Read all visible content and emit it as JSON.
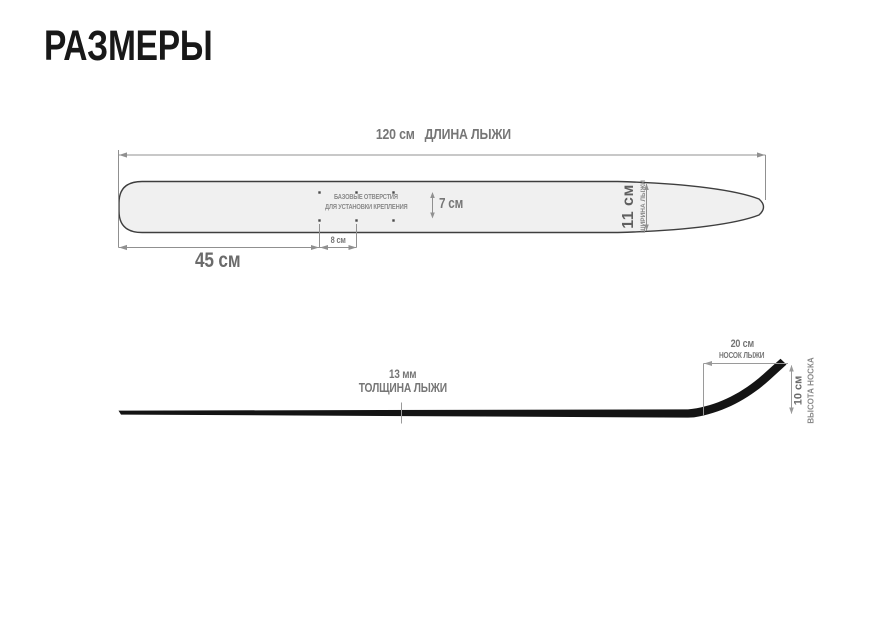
{
  "page": {
    "title": "РАЗМЕРЫ"
  },
  "colors": {
    "title_text": "#181818",
    "dimension_text": "#767676",
    "dimension_line": "#909090",
    "ski_fill": "#f0f0f0",
    "ski_outline": "#3e3e3e",
    "side_profile": "#141414"
  },
  "top_view": {
    "length_value": "120 см",
    "length_caption": "ДЛИНА ЛЫЖИ",
    "tail_to_holes_label": "45 см",
    "hole_column_spacing_label": "8 см",
    "hole_row_gap_label": "7 см",
    "width_value": "11 см",
    "width_caption": "ШИРИНА ЛЫЖИ",
    "holes_note_line1": "БАЗОВЫЕ ОТВЕРСТИЯ",
    "holes_note_line2": "ДЛЯ УСТАНОВКИ КРЕПЛЕНИЯ",
    "holes_count": 6
  },
  "side_view": {
    "thickness_value": "13 мм",
    "thickness_caption": "ТОЛЩИНА ЛЫЖИ",
    "tip_length_value": "20 см",
    "tip_length_caption": "НОСОК ЛЫЖИ",
    "tip_height_value": "10 см",
    "tip_height_caption": "ВЫСОТА НОСКА"
  }
}
